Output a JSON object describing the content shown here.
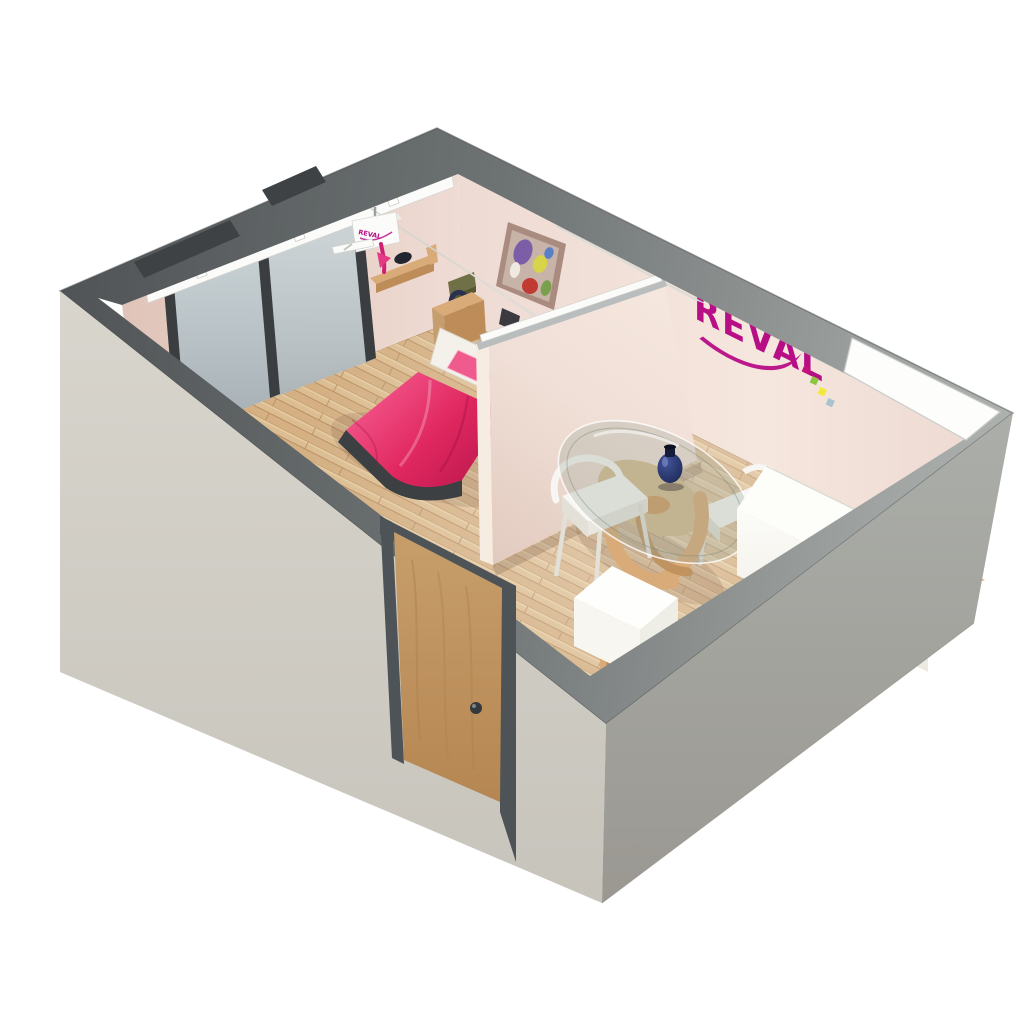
{
  "scene": {
    "type": "3d-floorplan-cutaway-render",
    "brand": {
      "logo_text": "REVAL",
      "hoist_label": "REVAL",
      "logo_color": "#b70e86",
      "logo_squares": [
        "#c4117e",
        "#8bc541",
        "#f3e93a",
        "#a9c2cf"
      ]
    },
    "rooms": [
      {
        "name": "bedroom",
        "furniture": [
          "bed",
          "nightstand",
          "wall-shelf",
          "sliding-glass-doors",
          "ceiling-hoist-rails",
          "wall-art"
        ]
      },
      {
        "name": "dining-area",
        "furniture": [
          "round-glass-table",
          "dining-chairs",
          "counter",
          "cube-table",
          "radiator",
          "vase"
        ]
      }
    ],
    "palette": {
      "background": "#ffffff",
      "wall_top_dark": "#505456",
      "wall_top_mid": "#6e7374",
      "wall_top_light": "#aeb2af",
      "notch_dark": "#3e4245",
      "window_white": "#fdfdfc",
      "exterior_left": "#d8d5cd",
      "exterior_left_dark": "#c7c4bc",
      "exterior_right": "#abaea9",
      "exterior_right_dark": "#9b9892",
      "interior_wall": "#eedbd3",
      "interior_wall_light": "#f5e6de",
      "interior_wall_dark": "#e0c4b9",
      "partition_wall": "#f0dfd6",
      "partition_wall_dark": "#e2cabf",
      "partition_edge": "#f6ece1",
      "partition_top": "#b9bdbd",
      "floor_wood": "#dcbd92",
      "floor_wood_dark": "#cda577",
      "floor_wood_seam": "#b98f63",
      "floor_wood_light": "#e9d0a8",
      "door_wood": "#c79e6a",
      "door_wood_dark": "#b2824e",
      "door_frame": "#4d5357",
      "door_knob": "#34393d",
      "glass_panel": "#b9c2c6",
      "glass_panel_light": "#c9d2d5",
      "glass_panel_dark": "#a5aeb3",
      "glass_frame": "#3a3e41",
      "rail_white": "#fbfbfa",
      "bed_duvet": "#e0275f",
      "bed_duvet_light": "#f2558a",
      "bed_duvet_dark": "#c01a51",
      "bed_base": "#3c4043",
      "bed_pillow": "#ee5b8c",
      "bed_headboard": "#f4f1ea",
      "furniture_wood": "#d8ab79",
      "furniture_wood_dark": "#bd8c58",
      "chair_white": "#f7f6f2",
      "chair_shadow": "#e2e0d7",
      "counter_white": "#fdfdfa",
      "counter_shadow": "#ebe9e0",
      "cube_white": "#fefefc",
      "vase_blue": "#1c2650",
      "vase_blue_light": "#41549a",
      "olive_box": "#707046",
      "lamp_blue": "#2a3150",
      "art_frame": "#a98b80",
      "art_canvas": "#c8b3a9"
    }
  }
}
